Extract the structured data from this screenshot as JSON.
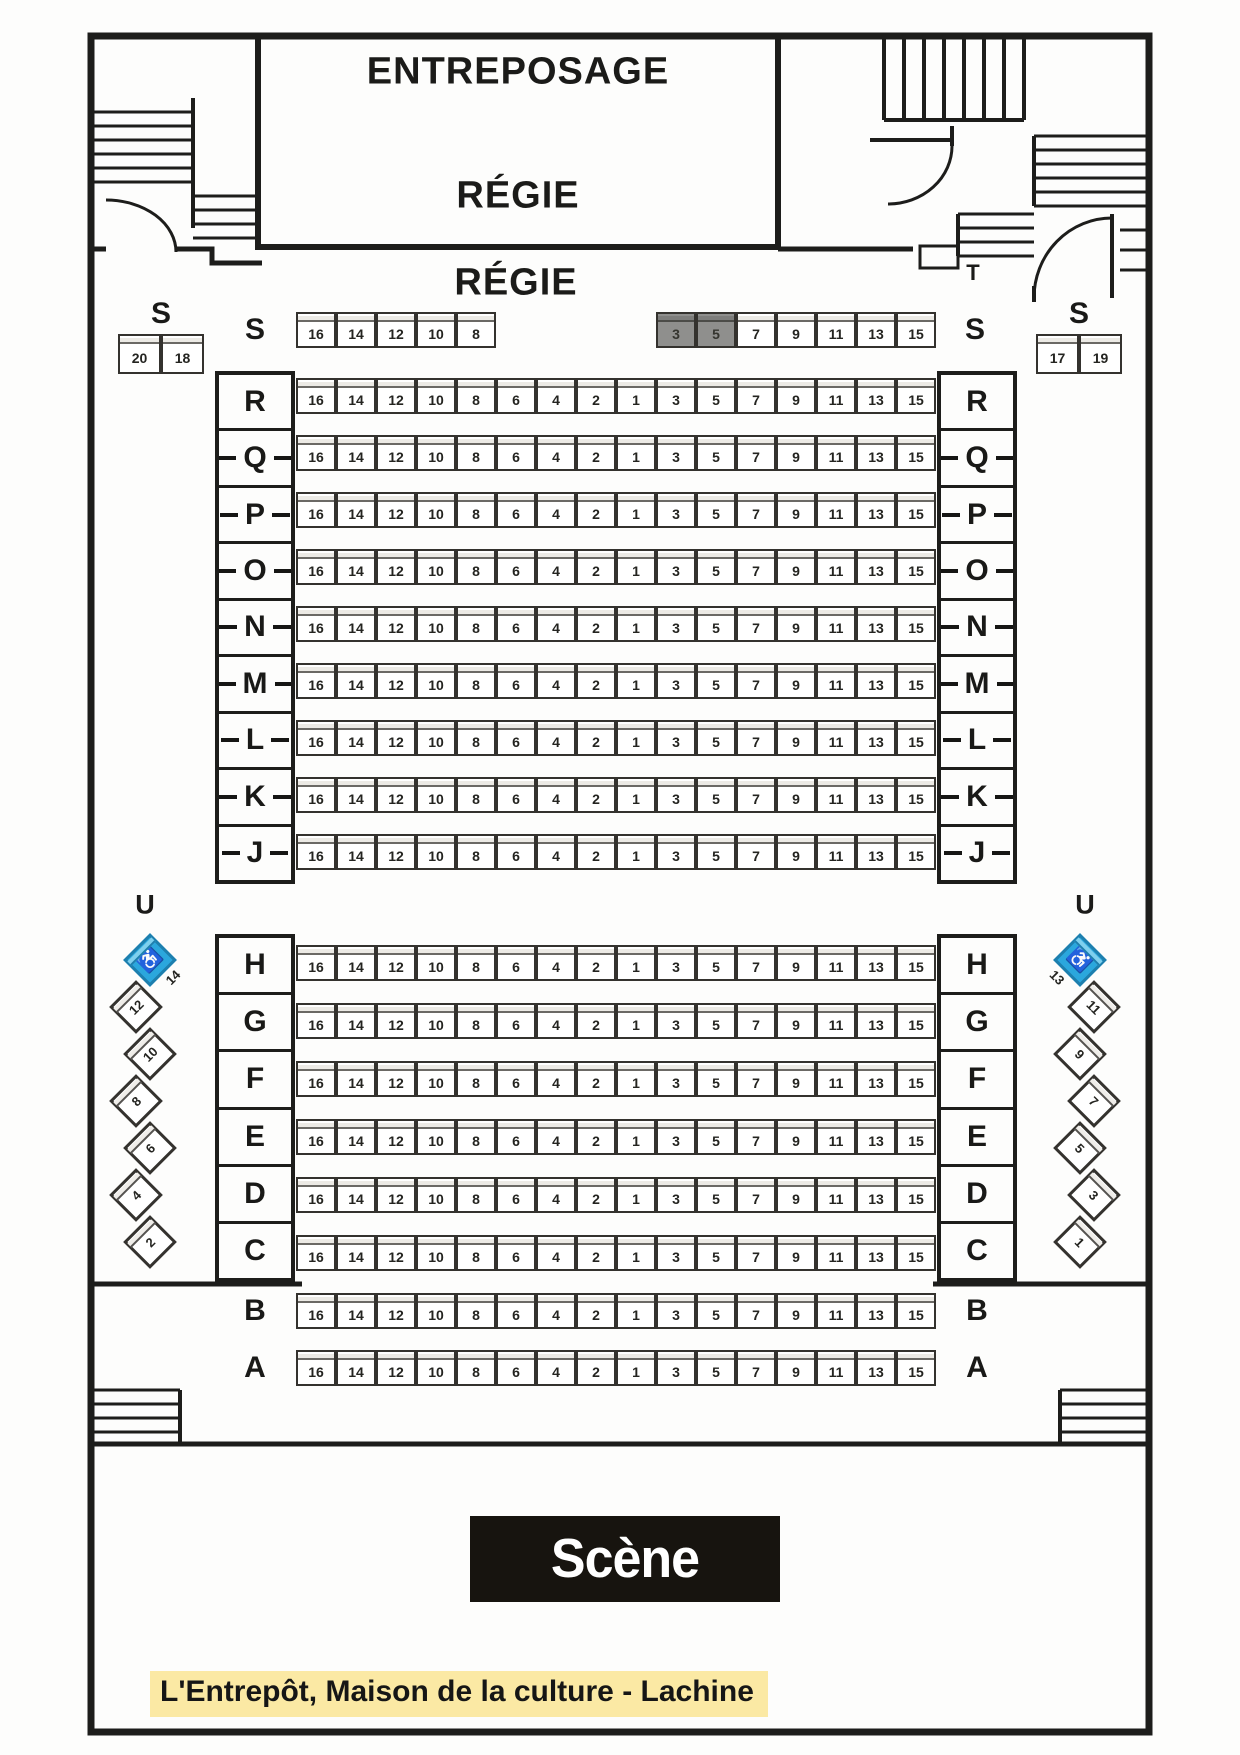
{
  "areas": {
    "entreposage": "ENTREPOSAGE",
    "regie_room": "RÉGIE",
    "regie_floor": "RÉGIE",
    "corridor_t": "T",
    "corridor_u": "U",
    "stage_label": "Scène",
    "caption": "L'Entrepôt, Maison de la culture - Lachine"
  },
  "seat_map": {
    "full_row": [
      "16",
      "14",
      "12",
      "10",
      "8",
      "6",
      "4",
      "2",
      "1",
      "3",
      "5",
      "7",
      "9",
      "11",
      "13",
      "15"
    ],
    "row_s": {
      "label": "S",
      "left_seats": [
        "16",
        "14",
        "12",
        "10",
        "8"
      ],
      "right_seats": [
        "3",
        "5",
        "7",
        "9",
        "11",
        "13",
        "15"
      ],
      "unavailable": [
        "3",
        "5"
      ]
    },
    "side_box_left": {
      "label": "S",
      "seats": [
        "20",
        "18"
      ]
    },
    "side_box_right": {
      "label": "S",
      "seats": [
        "17",
        "19"
      ]
    },
    "back_rows": [
      "R",
      "Q",
      "P",
      "O",
      "N",
      "M",
      "L",
      "K",
      "J"
    ],
    "middle_rows": [
      "H",
      "G",
      "F",
      "E",
      "D",
      "C"
    ],
    "front_rows": [
      "B",
      "A"
    ],
    "diagonal_left": {
      "corridor": "U",
      "seats": [
        "14",
        "12",
        "10",
        "8",
        "6",
        "4",
        "2"
      ],
      "wheelchair_seat": "14"
    },
    "diagonal_right": {
      "corridor": "U",
      "seats": [
        "13",
        "11",
        "9",
        "7",
        "5",
        "3",
        "1"
      ],
      "wheelchair_seat": "13"
    }
  },
  "colors": {
    "wall": "#1d1d1b",
    "seat_fill": "#ffffff",
    "seat_border": "#34322e",
    "reserved_fill": "#8f8f8d",
    "wheelchair_fill": "#2ba7dd",
    "stage_bg": "#17140f",
    "stage_text": "#ffffff",
    "caption_highlight": "#fbe9a4"
  },
  "icons": {
    "wheelchair": "♿"
  }
}
